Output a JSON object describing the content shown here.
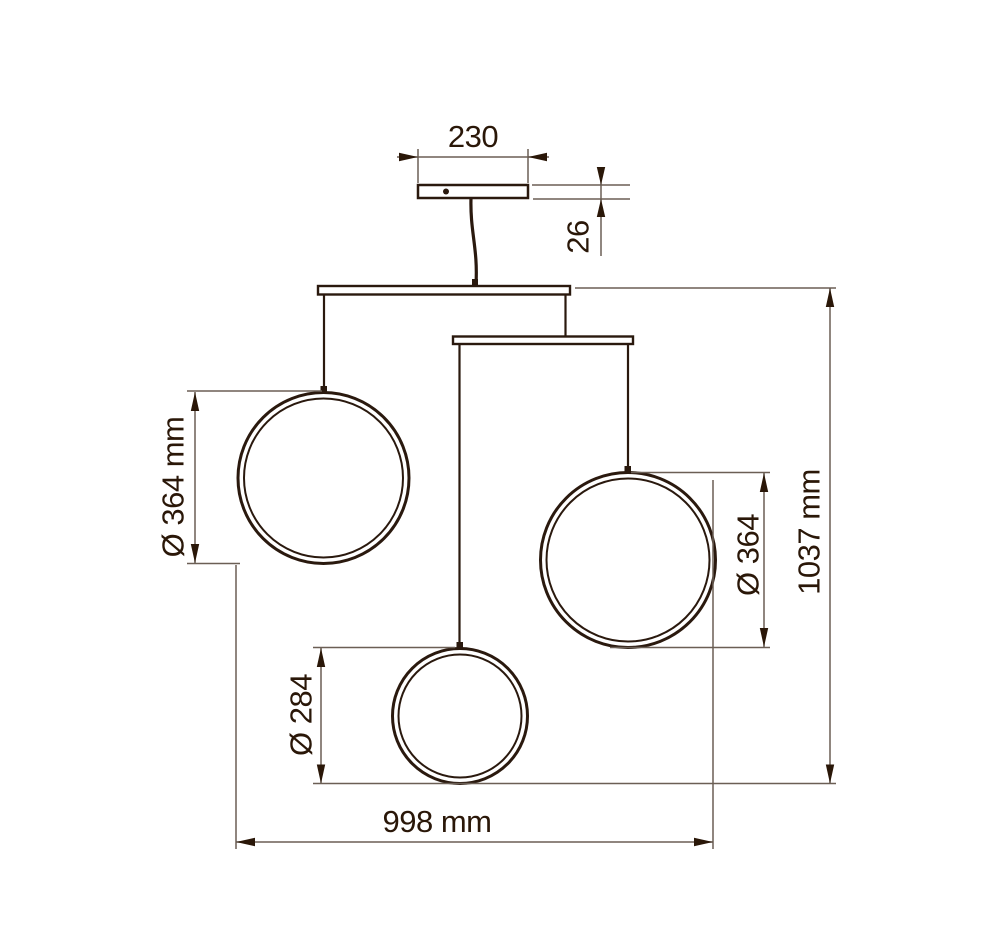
{
  "drawing": {
    "title": "Pendant lamp technical dimension drawing",
    "colors": {
      "background": "#ffffff",
      "object_line": "#2a190e",
      "dimension_line": "#6b5f55",
      "text": "#2a1708"
    },
    "dims": {
      "canopy_width": "230",
      "canopy_height": "26",
      "left_ring_diameter": "Ø 364 mm",
      "right_ring_diameter": "Ø 364",
      "bottom_ring_diameter": "Ø 284",
      "overall_width": "998 mm",
      "overall_height": "1037 mm"
    }
  }
}
